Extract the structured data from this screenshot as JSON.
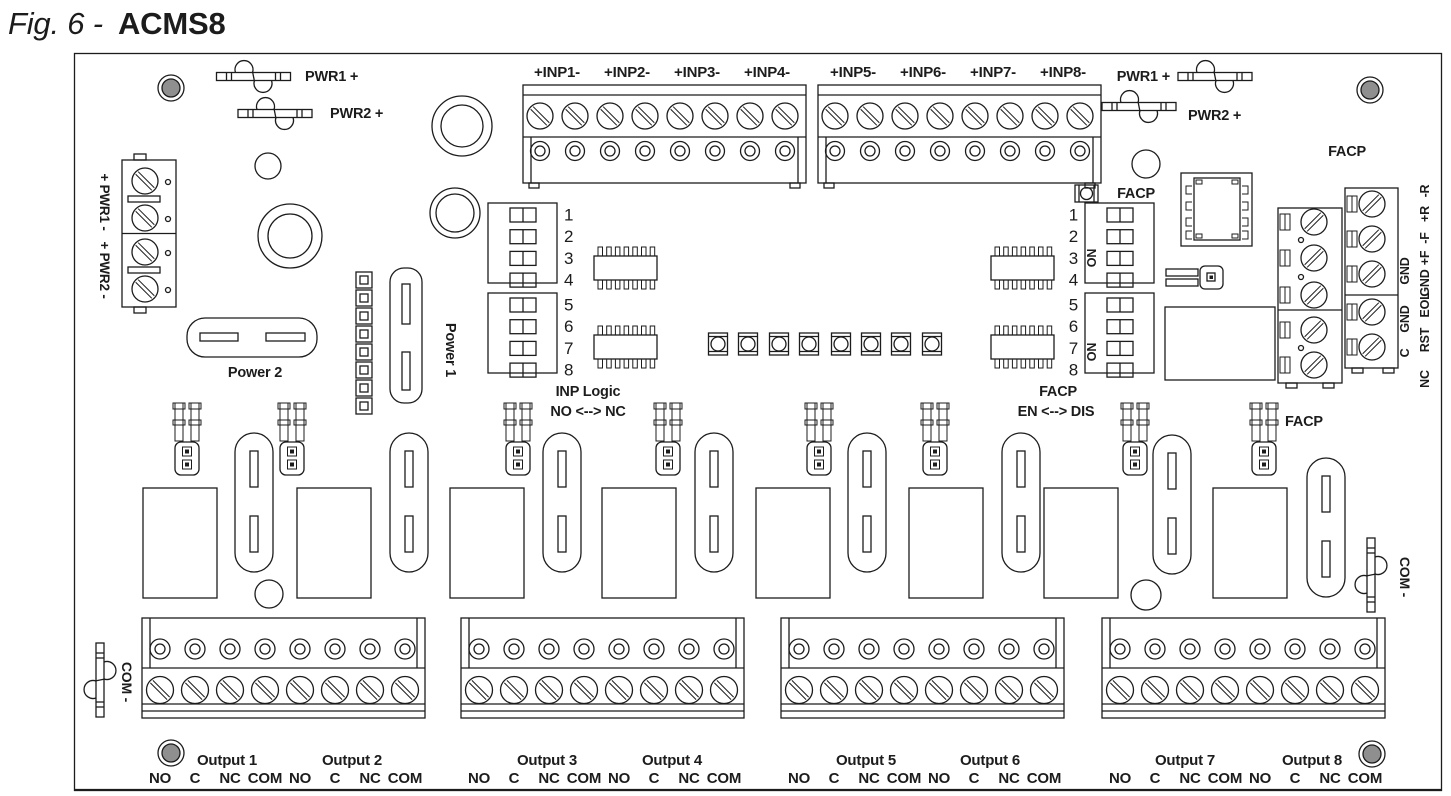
{
  "title": {
    "prefix": "Fig. 6 -",
    "name": "ACMS8"
  },
  "colors": {
    "line": "#1c1c1c",
    "hole_gray": "#8f8f8f",
    "background": "#ffffff"
  },
  "board": {
    "fuse_labels": {
      "pwr1": "PWR1 +",
      "pwr2": "PWR2 +"
    },
    "inputs": [
      "+INP1-",
      "+INP2-",
      "+INP3-",
      "+INP4-",
      "+INP5-",
      "+INP6-",
      "+INP7-",
      "+INP8-"
    ],
    "facp_corner_label": "FACP",
    "left": {
      "pwr1_vertical": "+ PWR1 -",
      "pwr2_vertical": "+ PWR2 -",
      "power1": "Power 1",
      "power2": "Power 2"
    },
    "com_label": "COM -",
    "dip": {
      "numbers": [
        "1",
        "2",
        "3",
        "4",
        "5",
        "6",
        "7",
        "8"
      ],
      "on_label": "ON",
      "inp_caption": [
        "INP Logic",
        "NO <--> NC"
      ],
      "facp_caption": [
        "FACP",
        "EN <--> DIS"
      ],
      "facp_dip_label": "FACP",
      "facp_jumper_label": "FACP"
    },
    "edge_labels": {
      "outer": [
        "-R",
        "+R",
        "-F",
        "+F",
        "GND",
        "EOL",
        "RST",
        "NC"
      ],
      "inner": [
        "GND",
        "GND",
        "C"
      ]
    },
    "outputs": {
      "names": [
        "Output 1",
        "Output 2",
        "Output 3",
        "Output 4",
        "Output 5",
        "Output 6",
        "Output 7",
        "Output 8"
      ],
      "terminal_labels": [
        "NO",
        "C",
        "NC",
        "COM"
      ]
    }
  }
}
